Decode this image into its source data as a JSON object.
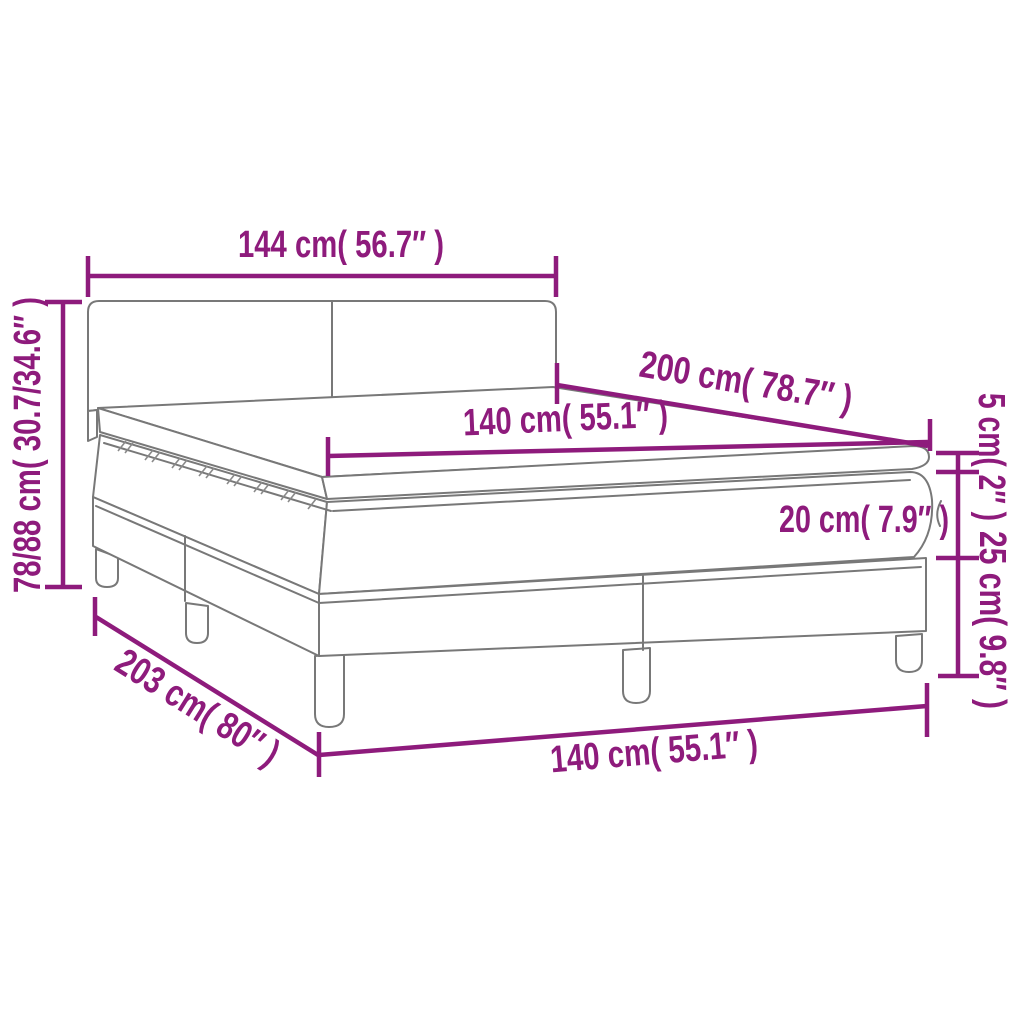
{
  "page": {
    "background": "#ffffff"
  },
  "diagram": {
    "subject": "box-spring-bed-with-mattress-topper-dimension-diagram",
    "colors": {
      "dimension_accent": "#8e1b7c",
      "outline_gray": "#787878",
      "fill": "#ffffff"
    },
    "dims": {
      "headboard_width": {
        "label": "144 cm( 56.7″ )"
      },
      "length_top": {
        "label": "200 cm( 78.7″ )"
      },
      "mattress_width": {
        "label": "140 cm( 55.1″ )"
      },
      "height_total": {
        "label": "78/88 cm( 30.7/34.6″ )"
      },
      "topper_height": {
        "label": "5 cm( 2″ )"
      },
      "mattress_height": {
        "label": "20 cm( 7.9″ )"
      },
      "base_height": {
        "label": "25 cm( 9.8″ )"
      },
      "length_bottom": {
        "label": "203 cm( 80″ )"
      },
      "base_width": {
        "label": "140 cm( 55.1″ )"
      }
    }
  }
}
